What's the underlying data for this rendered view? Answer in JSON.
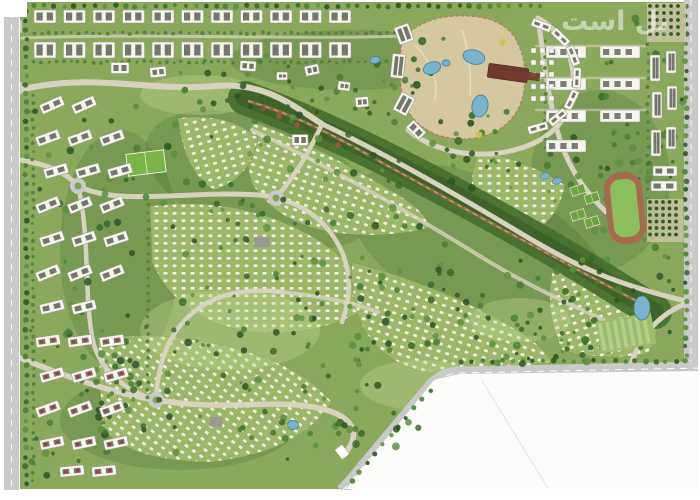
{
  "watermark": {
    "text": "بل است"
  },
  "map": {
    "palette": {
      "page_bg": "#ffffff",
      "site_green": "#8aa95c",
      "shade_dark": "#33592a",
      "lawn_light": "#c2d893",
      "villa_bg": "#9db968",
      "villa_tile": "#f3f1e4",
      "villa_tile_edge": "#7e9752",
      "road_outer": "#c9c9c7",
      "road_internal": "#d8d3c1",
      "road_dash": "#ffffff",
      "wadi_band": "#47702e",
      "wadi_core": "#3a5f25",
      "stream_brown": "#8a6a44",
      "stream_sand": "#c8a872",
      "rust": "#a2553d",
      "park_sand": "#d5c89e",
      "park_trail": "#c0765f",
      "pond_fill": "#7ab4cc",
      "pond_edge": "#4a84a0",
      "building_white": "#f6f5ee",
      "building_edge": "#97978c",
      "slot_dark": "#5d6055",
      "red_roof": "#a93c30",
      "gray_block": "#9a9a92",
      "clubhouse": "#6f3a2d",
      "clubhouse_dark": "#4f2a20",
      "track_ring": "#a86a4e",
      "track_field": "#8cc05f",
      "court_green": "#6fa344",
      "court_line": "#dfeccb",
      "pitch_green": "#79b647",
      "paddock_a": "#9cbd6d",
      "paddock_b": "#b6d08a",
      "orchard_bg": "#cdc4a4",
      "orchard_dot": "#2f5a28",
      "hedge": "#54803a",
      "parcel_white": "#fcfcfb",
      "parcel_line": "#e4e4e1",
      "tree_palette": [
        "#2d5524",
        "#3a6a2c",
        "#497f35",
        "#5c9140"
      ],
      "park_tree_palette": [
        "#2d5524",
        "#3a6a2c",
        "#d4c24a",
        "#497f35"
      ]
    },
    "base": {
      "x": 16,
      "y": 2,
      "w": 674,
      "h": 487
    },
    "shading": [
      [
        260,
        180,
        120,
        60,
        20
      ],
      [
        480,
        250,
        140,
        70,
        25
      ],
      [
        180,
        420,
        120,
        50,
        0
      ],
      [
        600,
        180,
        70,
        90,
        0
      ],
      [
        350,
        60,
        120,
        30,
        0
      ],
      [
        120,
        250,
        60,
        120,
        0
      ]
    ],
    "lawns": [
      [
        230,
        330,
        90,
        40
      ],
      [
        420,
        385,
        60,
        25
      ],
      [
        200,
        95,
        60,
        20
      ],
      [
        520,
        320,
        50,
        22
      ]
    ],
    "villas": {
      "tile": {
        "w": 9,
        "h": 7.5,
        "bx": 1.2,
        "by": 1.6,
        "bw": 4.6,
        "bh": 3.4
      },
      "variants": [
        0,
        18,
        -15,
        35
      ],
      "blocks": [
        [
          "M253,122 Q320,146 400,196 Q430,215 428,228 Q380,240 330,232 Q276,222 252,184 Q242,150 253,122 Z",
          1
        ],
        [
          "M178,118 Q228,112 258,138 Q252,178 214,190 Q184,172 178,118 Z",
          2
        ],
        [
          "M150,206 Q232,196 300,230 Q352,256 378,300 Q330,338 252,332 Q178,322 152,262 Z",
          0
        ],
        [
          "M98,338 Q172,330 242,350 Q305,368 332,402 Q300,452 212,462 Q130,462 102,428 Z",
          3
        ],
        [
          "M352,262 Q442,286 510,326 Q545,346 552,362 Q490,372 424,372 Q374,360 358,316 Q350,286 352,262 Z",
          1
        ],
        [
          "M558,252 Q618,270 652,300 Q664,330 648,354 Q600,362 562,350 Q540,302 558,252 Z",
          2
        ],
        [
          "M480,150 Q530,162 565,185 Q560,215 535,232 Q495,224 472,196 Q470,168 480,150 Z",
          0
        ]
      ]
    },
    "wadi": {
      "band": "M245,98 C320,125 390,160 450,192 C510,224 570,258 628,295 L655,312",
      "stream": "M248,101 C300,116 342,140 388,166 C432,190 470,212 515,236 C560,260 600,282 648,307",
      "rust": [
        [
          263,
          108
        ],
        [
          279,
          116
        ],
        [
          297,
          125
        ],
        [
          316,
          134
        ],
        [
          338,
          145
        ]
      ]
    },
    "park": {
      "path": "M402,40 Q420,18 455,16 Q500,14 515,38 Q528,60 524,90 Q520,118 495,132 Q465,145 435,134 Q408,122 402,95 Q398,65 402,40 Z",
      "inner_paths": [
        "M415,45 Q440,70 435,100",
        "M462,30 Q472,60 470,96"
      ],
      "trees_region": [
        405,
        20,
        115,
        115,
        12
      ]
    },
    "roads_internal": [
      [
        "M20,90 C90,72 150,92 215,86 C262,82 288,102 322,124",
        6,
        1
      ],
      [
        "M322,124 C382,152 452,192 522,234 C572,264 612,284 690,302",
        5,
        1
      ],
      [
        "M252,130 C320,162 400,207 470,250 C520,282 565,302 604,320",
        4,
        0.8
      ],
      [
        "M408,130 C440,158 500,162 540,140 C570,122 580,94 570,58 C564,38 552,26 538,18",
        5,
        1
      ],
      [
        "M20,160 C46,164 66,172 78,186 C122,208 200,188 268,196",
        5,
        1
      ],
      [
        "M276,198 C310,206 330,226 342,252 C352,276 350,300 342,322",
        4.5,
        1
      ],
      [
        "M276,198 C298,172 310,150 322,124",
        4.5,
        1
      ],
      [
        "M20,358 C70,378 116,394 156,400 C230,412 268,398 318,408 C352,415 362,432 346,452",
        5.5,
        1
      ],
      [
        "M156,400 C158,360 170,330 196,310 C220,292 252,288 282,292",
        4.5,
        1
      ],
      [
        "M78,186 C90,236 84,290 92,336 C96,360 112,384 150,398",
        4.5,
        1
      ],
      [
        "M538,18 C544,60 548,100 560,140 C572,176 590,196 606,212",
        5,
        1
      ],
      [
        "M690,302 C662,312 644,332 634,356 L630,366",
        5,
        1
      ],
      [
        "M22,38 C150,33 300,40 402,36",
        3,
        0.75
      ],
      [
        "M536,46 L645,46",
        2.5,
        0.6
      ],
      [
        "M536,78 L645,78",
        2.5,
        0.6
      ],
      [
        "M536,110 L645,110",
        2.5,
        0.6
      ],
      [
        "M282,292 C320,296 352,302 378,312",
        4,
        0.8
      ]
    ],
    "roundabouts": [
      [
        78,
        186
      ],
      [
        276,
        198
      ],
      [
        156,
        400
      ]
    ],
    "left_road": {
      "rect": [
        3,
        0,
        17,
        490
      ],
      "branches": [
        [
          0,
          20,
          22,
          13
        ],
        [
          0,
          82,
          22,
          12
        ]
      ]
    },
    "right_road": {
      "rect": [
        684,
        0,
        14,
        368
      ]
    },
    "boundary_road": "M700,368 L458,373 Q440,375 431,386 L347,486 L342,491",
    "parcel": {
      "path": "M434,380 L459,374 L700,371 L700,489 L346,489 Z",
      "lines": [
        [
          482,
          381,
          548,
          488
        ]
      ]
    },
    "tree_lines": [
      [
        26,
        12,
        26,
        484,
        52,
        2.6,
        "t"
      ],
      [
        34,
        6,
        540,
        6,
        50,
        2.4,
        "t"
      ],
      [
        686,
        6,
        686,
        356,
        38,
        2.4,
        "t"
      ],
      [
        462,
        361,
        686,
        361,
        22,
        2.4,
        "t"
      ],
      [
        430,
        390,
        352,
        482,
        10,
        2.4,
        "t"
      ],
      [
        34,
        33,
        402,
        33,
        50,
        1.7,
        "h"
      ],
      [
        34,
        62,
        402,
        62,
        50,
        1.7,
        "h"
      ],
      [
        33,
        96,
        33,
        480,
        48,
        1.7,
        "h"
      ],
      [
        148,
        205,
        148,
        398,
        24,
        1.7,
        "h"
      ],
      [
        545,
        40,
        545,
        148,
        12,
        1.7,
        "h"
      ],
      [
        648,
        45,
        648,
        198,
        18,
        1.7,
        "h"
      ]
    ],
    "tree_regions": [
      [
        152,
        108,
        270,
        120,
        55
      ],
      [
        160,
        238,
        300,
        150,
        60
      ],
      [
        95,
        332,
        250,
        130,
        50
      ],
      [
        350,
        255,
        240,
        110,
        45
      ],
      [
        545,
        130,
        130,
        120,
        38
      ],
      [
        560,
        255,
        115,
        100,
        30
      ],
      [
        250,
        55,
        170,
        60,
        26
      ],
      [
        30,
        88,
        120,
        300,
        40
      ],
      [
        30,
        330,
        115,
        150,
        34
      ],
      [
        600,
        15,
        85,
        175,
        26
      ],
      [
        428,
        110,
        95,
        80,
        20
      ],
      [
        335,
        385,
        85,
        80,
        16
      ],
      [
        440,
        305,
        150,
        60,
        20
      ],
      [
        180,
        55,
        120,
        50,
        14
      ]
    ],
    "tree_seed": 1234567,
    "sports": {
      "track": {
        "cx": 625,
        "cy": 208,
        "w": 38,
        "h": 72,
        "rot": -6
      },
      "courts": {
        "items": [
          [
            578,
            190
          ],
          [
            592,
            198
          ],
          [
            578,
            215
          ],
          [
            592,
            222
          ]
        ],
        "w": 14,
        "h": 9,
        "rot": -18
      },
      "pools": [
        [
          545,
          176
        ],
        [
          557,
          181
        ]
      ],
      "paddock": {
        "cx": 626,
        "cy": 333,
        "w": 56,
        "h": 32,
        "rot": -10,
        "stripes": 7
      },
      "orchards": [
        {
          "x": 650,
          "y": 6,
          "cols": 5,
          "rows": 5,
          "dx": 7,
          "dy": 7
        },
        {
          "x": 650,
          "y": 202,
          "cols": 5,
          "rows": 6,
          "dx": 6.5,
          "dy": 6.5
        }
      ],
      "pitch": {
        "cx": 146,
        "cy": 163,
        "w": 38,
        "h": 22,
        "rot": -7
      }
    },
    "buildings": {
      "top_bands": [
        {
          "y": 10,
          "x0": 34,
          "count": 11,
          "step": 29.5,
          "w": 22,
          "h": 13
        },
        {
          "y": 42,
          "x0": 34,
          "count": 11,
          "step": 29.5,
          "w": 22,
          "h": 16
        }
      ],
      "right_grid": {
        "items": [
          [
            546,
            46
          ],
          [
            600,
            46
          ],
          [
            546,
            78
          ],
          [
            600,
            78
          ],
          [
            546,
            110
          ],
          [
            600,
            110
          ],
          [
            546,
            140
          ]
        ],
        "w": 40,
        "h": 12
      },
      "left_rows": [
        [
          40,
          100,
          2,
          -24,
          "w"
        ],
        [
          36,
          133,
          3,
          -20,
          "w"
        ],
        [
          44,
          166,
          3,
          -16,
          "w"
        ],
        [
          36,
          200,
          3,
          -22,
          "w"
        ],
        [
          40,
          234,
          3,
          -18,
          "w"
        ],
        [
          36,
          268,
          3,
          -22,
          "w"
        ],
        [
          40,
          302,
          2,
          -14,
          "w"
        ],
        [
          36,
          336,
          3,
          -8,
          "r"
        ],
        [
          40,
          370,
          3,
          -16,
          "r"
        ],
        [
          36,
          404,
          3,
          -20,
          "r"
        ],
        [
          40,
          438,
          3,
          -12,
          "r"
        ],
        [
          60,
          466,
          2,
          -6,
          "r"
        ]
      ],
      "left_row_step": 32,
      "left_row_w": 24,
      "left_row_h": 10,
      "right_strip": [
        [
          655,
          68,
          10,
          26,
          0
        ],
        [
          671,
          62,
          10,
          22,
          0
        ],
        [
          657,
          105,
          10,
          26,
          0
        ],
        [
          672,
          98,
          10,
          24,
          0
        ],
        [
          656,
          143,
          10,
          26,
          0
        ],
        [
          671,
          138,
          10,
          22,
          0
        ],
        [
          665,
          171,
          24,
          10,
          0
        ],
        [
          664,
          186,
          26,
          10,
          0
        ]
      ],
      "plaza": {
        "cx": 523,
        "cy": 76,
        "r": 54,
        "angles": [
          -70,
          -46,
          -22,
          2,
          26,
          50,
          74
        ],
        "slab_w": 20,
        "slab_h": 8,
        "terrace": {
          "x0": 531,
          "y0": 48,
          "cols": 3,
          "rows": 5,
          "dx": 9,
          "dy": 12,
          "s": 5
        }
      },
      "clubhouse": {
        "x": 508,
        "y": 73,
        "w": 40,
        "h": 14,
        "rot": 8,
        "ext": [
          18,
          -4,
          14,
          8
        ]
      },
      "misc": [
        [
          404,
          34,
          15,
          18,
          -20,
          "w"
        ],
        [
          398,
          66,
          13,
          24,
          6,
          "w"
        ],
        [
          404,
          104,
          15,
          20,
          28,
          "w"
        ],
        [
          416,
          130,
          18,
          11,
          45,
          "w"
        ],
        [
          312,
          70,
          14,
          10,
          -12,
          "w"
        ],
        [
          344,
          86,
          12,
          9,
          8,
          "w"
        ],
        [
          282,
          76,
          11,
          8,
          0,
          "w"
        ],
        [
          362,
          102,
          13,
          10,
          -5,
          "w"
        ],
        [
          300,
          140,
          16,
          11,
          0,
          "w"
        ],
        [
          120,
          68,
          18,
          11,
          0,
          "w"
        ],
        [
          158,
          72,
          16,
          10,
          -6,
          "w"
        ],
        [
          248,
          66,
          16,
          10,
          4,
          "w"
        ],
        [
          262,
          242,
          15,
          10,
          0,
          "g"
        ],
        [
          216,
          422,
          12,
          9,
          0,
          "g"
        ],
        [
          342,
          452,
          9,
          12,
          -38,
          "gate"
        ]
      ]
    },
    "lakes": [
      [
        642,
        308,
        8,
        12,
        0
      ],
      [
        293,
        425,
        5.5,
        4.5,
        0
      ],
      [
        375,
        60,
        5,
        3.5,
        -10
      ],
      [
        432,
        68,
        9,
        6,
        -20
      ],
      [
        474,
        57,
        11,
        7,
        15
      ],
      [
        480,
        106,
        8,
        11,
        10
      ],
      [
        446,
        63,
        4,
        3,
        0
      ]
    ],
    "margins": [
      [
        0,
        0,
        3,
        500
      ],
      [
        698,
        0,
        2,
        500
      ],
      [
        0,
        490,
        700,
        10
      ],
      [
        0,
        0,
        27,
        17
      ]
    ]
  }
}
